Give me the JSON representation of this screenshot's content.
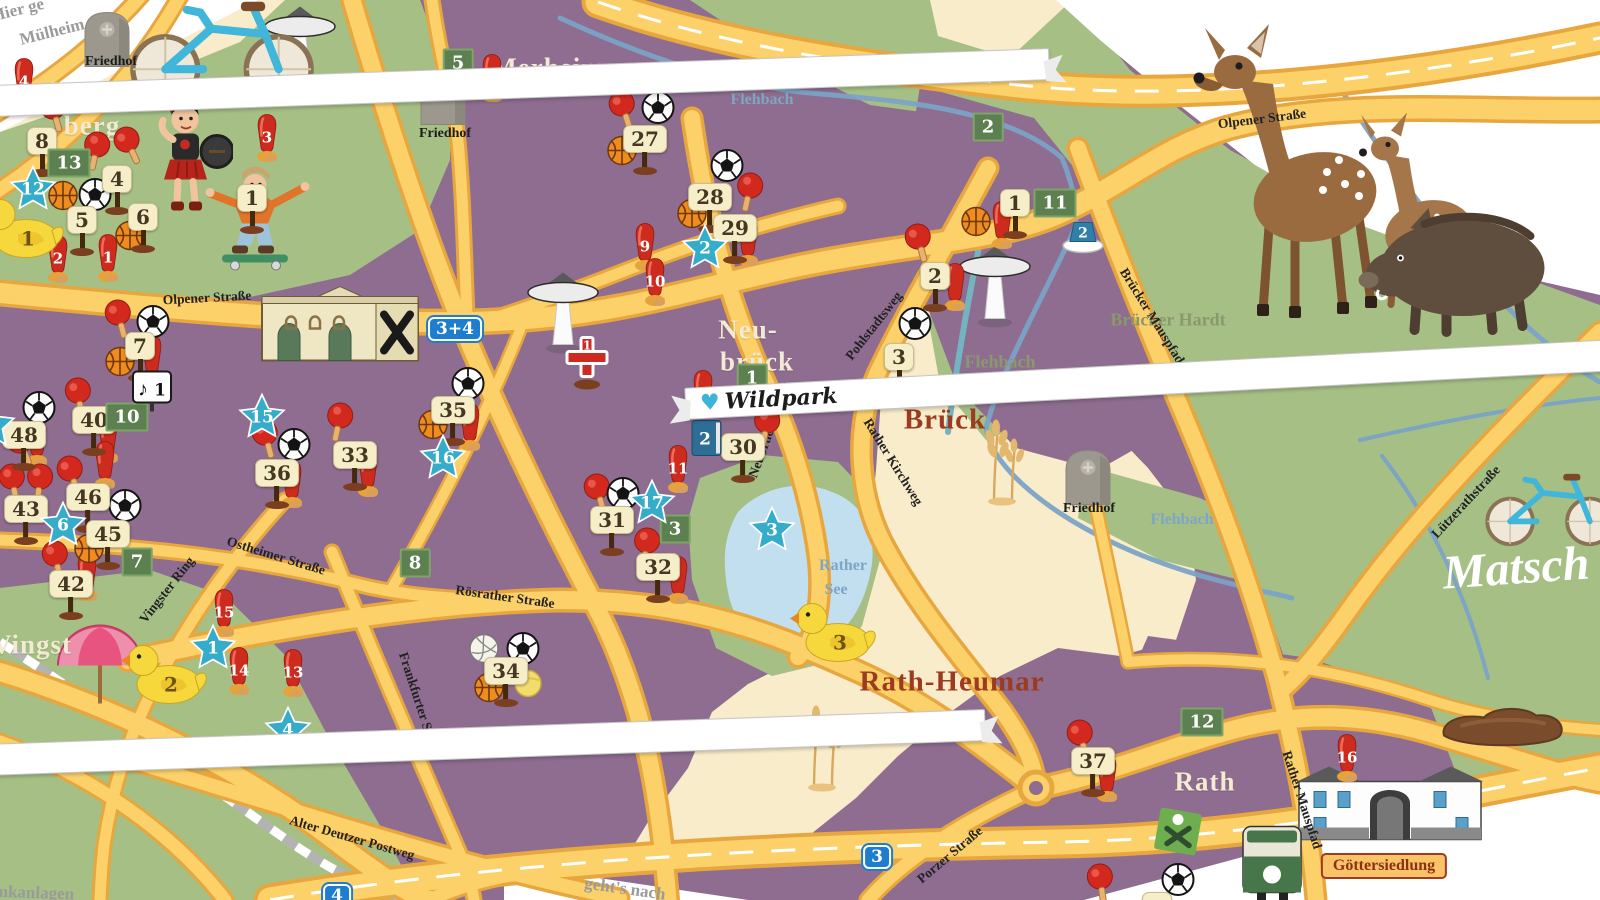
{
  "colors": {
    "purple": "#8e6d90",
    "green": "#a5bf85",
    "cream": "#f9ecca",
    "road_fill": "#fcd169",
    "road_edge": "#e8a73e",
    "lake": "#c2dff0",
    "river": "#7ba3c6",
    "star": "#35adca",
    "cone_red": "#cd2b1d",
    "sign_cream": "#f5eec9",
    "green_sign": "#5d8050",
    "blue_sign": "#1e7ecd"
  },
  "labels": {
    "districts": [
      {
        "text": "Höhen-",
        "x": 96,
        "y": 92
      },
      {
        "text": "berg",
        "x": 92,
        "y": 126
      },
      {
        "text": "Merheim",
        "x": 548,
        "y": 68
      },
      {
        "text": "Neu-",
        "x": 748,
        "y": 330
      },
      {
        "text": "brück",
        "x": 757,
        "y": 362
      },
      {
        "text": "Vingst",
        "x": 32,
        "y": 645
      },
      {
        "text": "Ostheim",
        "x": 350,
        "y": 742
      },
      {
        "text": "Rath",
        "x": 1205,
        "y": 782
      }
    ],
    "districts_red": [
      {
        "text": "Brück",
        "x": 945,
        "y": 420
      },
      {
        "text": "Rath-Heumar",
        "x": 952,
        "y": 682
      }
    ],
    "nature": [
      {
        "text": "Brücker Hardt",
        "x": 1168,
        "y": 320
      },
      {
        "text": "Flehbach",
        "x": 1000,
        "y": 362
      },
      {
        "text": "Aue",
        "x": 984,
        "y": 384
      }
    ],
    "waters": [
      {
        "text": "Flehbach",
        "x": 762,
        "y": 100
      },
      {
        "text": "Flehbach",
        "x": 1182,
        "y": 520
      },
      {
        "text": "Flehbach",
        "x": 1434,
        "y": 366
      },
      {
        "text": "Rather",
        "x": 843,
        "y": 566
      },
      {
        "text": "See",
        "x": 836,
        "y": 590
      }
    ],
    "streets": [
      {
        "text": "Olpener Straße",
        "x": 207,
        "y": 298,
        "rot": -3
      },
      {
        "text": "Olpener Straße",
        "x": 1262,
        "y": 119,
        "rot": -7
      },
      {
        "text": "Ostheimer Straße",
        "x": 276,
        "y": 556,
        "rot": 17
      },
      {
        "text": "Vingster Ring",
        "x": 167,
        "y": 590,
        "rot": -52
      },
      {
        "text": "Frankfurter Straße",
        "x": 420,
        "y": 706,
        "rot": 72
      },
      {
        "text": "Rösrather Straße",
        "x": 505,
        "y": 597,
        "rot": 8
      },
      {
        "text": "Alter Deutzer Postweg",
        "x": 352,
        "y": 838,
        "rot": 16
      },
      {
        "text": "Porzer Straße",
        "x": 950,
        "y": 855,
        "rot": -40
      },
      {
        "text": "Pohlstadtsweg",
        "x": 874,
        "y": 326,
        "rot": -52
      },
      {
        "text": "Rather Kirchweg",
        "x": 893,
        "y": 462,
        "rot": 58
      },
      {
        "text": "Neubrücker Ring",
        "x": 770,
        "y": 430,
        "rot": -70
      },
      {
        "text": "Brücker Mauspfad",
        "x": 1152,
        "y": 316,
        "rot": 58
      },
      {
        "text": "Rather Mauspfad",
        "x": 1302,
        "y": 800,
        "rot": 72
      },
      {
        "text": "Lützerathstraße",
        "x": 1466,
        "y": 502,
        "rot": -47
      }
    ],
    "pois": [
      {
        "text": "Friedhof",
        "x": 111,
        "y": 62
      },
      {
        "text": "Friedhof",
        "x": 445,
        "y": 134
      },
      {
        "text": "Friedhof",
        "x": 1089,
        "y": 509
      }
    ],
    "corners": [
      {
        "text": "Hier ge",
        "x": 18,
        "y": 10,
        "rot": -14
      },
      {
        "text": "Mülheim",
        "x": 52,
        "y": 32,
        "rot": -14
      },
      {
        "text": "mkanlagen",
        "x": 34,
        "y": 893,
        "rot": 2
      },
      {
        "text": "geht's nach",
        "x": 625,
        "y": 889,
        "rot": 8
      }
    ],
    "script": {
      "text": "Matsch",
      "x": 1516,
      "y": 568,
      "rot": -4
    },
    "plaque": {
      "text": "Göttersiedlung",
      "x": 1384,
      "y": 866
    }
  },
  "banners": [
    {
      "text": "Merheimer Heide",
      "x": 250,
      "y": 92,
      "rot": -2
    },
    {
      "text": "Naturfreibad",
      "x": 186,
      "y": 721,
      "rot": -2
    },
    {
      "text": "Wildpark",
      "x": 1484,
      "y": 298,
      "rot": -3
    }
  ],
  "markers": {
    "signs": [
      {
        "n": "8",
        "x": 42,
        "y": 138
      },
      {
        "n": "4",
        "x": 117,
        "y": 176
      },
      {
        "n": "5",
        "x": 82,
        "y": 217
      },
      {
        "n": "6",
        "x": 143,
        "y": 214
      },
      {
        "n": "1",
        "x": 252,
        "y": 195
      },
      {
        "n": "7",
        "x": 140,
        "y": 343
      },
      {
        "n": "40",
        "x": 94,
        "y": 417
      },
      {
        "n": "48",
        "x": 24,
        "y": 432
      },
      {
        "n": "36",
        "x": 277,
        "y": 470
      },
      {
        "n": "33",
        "x": 355,
        "y": 452
      },
      {
        "n": "43",
        "x": 26,
        "y": 506
      },
      {
        "n": "46",
        "x": 88,
        "y": 494
      },
      {
        "n": "45",
        "x": 108,
        "y": 531
      },
      {
        "n": "42",
        "x": 71,
        "y": 581
      },
      {
        "n": "35",
        "x": 453,
        "y": 407
      },
      {
        "n": "31",
        "x": 612,
        "y": 517
      },
      {
        "n": "32",
        "x": 658,
        "y": 564
      },
      {
        "n": "30",
        "x": 743,
        "y": 444
      },
      {
        "n": "27",
        "x": 645,
        "y": 136
      },
      {
        "n": "28",
        "x": 710,
        "y": 194
      },
      {
        "n": "29",
        "x": 735,
        "y": 225
      },
      {
        "n": "1",
        "x": 1015,
        "y": 200
      },
      {
        "n": "2",
        "x": 935,
        "y": 273
      },
      {
        "n": "3",
        "x": 899,
        "y": 354
      },
      {
        "n": "34",
        "x": 506,
        "y": 668
      },
      {
        "n": "37",
        "x": 1093,
        "y": 758
      },
      {
        "n": "",
        "x": 1157,
        "y": 903
      }
    ],
    "green_signs": [
      {
        "n": "13",
        "x": 69,
        "y": 163
      },
      {
        "n": "5",
        "x": 458,
        "y": 63
      },
      {
        "n": "2",
        "x": 988,
        "y": 127
      },
      {
        "n": "11",
        "x": 1055,
        "y": 203
      },
      {
        "n": "1",
        "x": 752,
        "y": 378
      },
      {
        "n": "10",
        "x": 127,
        "y": 417
      },
      {
        "n": "7",
        "x": 137,
        "y": 562
      },
      {
        "n": "8",
        "x": 415,
        "y": 563
      },
      {
        "n": "3",
        "x": 675,
        "y": 529
      },
      {
        "n": "12",
        "x": 1202,
        "y": 722
      }
    ],
    "blue_signs": [
      {
        "n": "4",
        "x": 887,
        "y": 68
      },
      {
        "n": "3+4",
        "x": 455,
        "y": 329
      },
      {
        "n": "3",
        "x": 877,
        "y": 857
      },
      {
        "n": "4",
        "x": 337,
        "y": 896
      }
    ],
    "stars": [
      {
        "n": "12",
        "x": 33,
        "y": 192
      },
      {
        "n": "2",
        "x": 705,
        "y": 251
      },
      {
        "n": "15",
        "x": 262,
        "y": 420
      },
      {
        "n": "16",
        "x": 443,
        "y": 461
      },
      {
        "n": "6",
        "x": 63,
        "y": 528
      },
      {
        "n": "17",
        "x": 652,
        "y": 506
      },
      {
        "n": "3",
        "x": 772,
        "y": 533
      },
      {
        "n": "1",
        "x": 213,
        "y": 651
      },
      {
        "n": "4",
        "x": 288,
        "y": 733
      },
      {
        "n": "4",
        "x": -8,
        "y": 428
      }
    ],
    "cones": [
      {
        "n": "4",
        "x": 24,
        "y": 85
      },
      {
        "n": "8",
        "x": 492,
        "y": 81
      },
      {
        "n": "3",
        "x": 267,
        "y": 141
      },
      {
        "n": "2",
        "x": 58,
        "y": 262
      },
      {
        "n": "1",
        "x": 108,
        "y": 261
      },
      {
        "n": "9",
        "x": 645,
        "y": 250
      },
      {
        "n": "10",
        "x": 655,
        "y": 285
      },
      {
        "n": "12",
        "x": 703,
        "y": 397
      },
      {
        "n": "11",
        "x": 678,
        "y": 472
      },
      {
        "n": "15",
        "x": 224,
        "y": 616
      },
      {
        "n": "14",
        "x": 239,
        "y": 674
      },
      {
        "n": "13",
        "x": 293,
        "y": 676
      },
      {
        "n": "16",
        "x": 1347,
        "y": 761
      }
    ],
    "plain_cones": [
      {
        "x": 152,
        "y": 362
      },
      {
        "x": 108,
        "y": 442
      },
      {
        "x": 292,
        "y": 487
      },
      {
        "x": 368,
        "y": 476
      },
      {
        "x": 470,
        "y": 430
      },
      {
        "x": 955,
        "y": 290
      },
      {
        "x": 748,
        "y": 245
      },
      {
        "x": 678,
        "y": 583
      },
      {
        "x": 1002,
        "y": 228
      },
      {
        "x": 37,
        "y": 445
      },
      {
        "x": 105,
        "y": 468
      },
      {
        "x": 87,
        "y": 580
      },
      {
        "x": 1107,
        "y": 781
      }
    ],
    "paddles": [
      {
        "x": 53,
        "y": 116,
        "r": -15
      },
      {
        "x": 97,
        "y": 154,
        "r": 12
      },
      {
        "x": 127,
        "y": 149,
        "r": -25
      },
      {
        "x": 118,
        "y": 322,
        "r": -15
      },
      {
        "x": 78,
        "y": 400,
        "r": -8
      },
      {
        "x": 265,
        "y": 442,
        "r": -15
      },
      {
        "x": 340,
        "y": 425,
        "r": 12
      },
      {
        "x": 12,
        "y": 486,
        "r": -10
      },
      {
        "x": 40,
        "y": 486,
        "r": 6
      },
      {
        "x": 70,
        "y": 478,
        "r": -18
      },
      {
        "x": 20,
        "y": 450,
        "r": -22
      },
      {
        "x": 55,
        "y": 563,
        "r": -12
      },
      {
        "x": 597,
        "y": 496,
        "r": -15
      },
      {
        "x": 647,
        "y": 550,
        "r": 8
      },
      {
        "x": 767,
        "y": 430,
        "r": 10
      },
      {
        "x": 750,
        "y": 195,
        "r": 12
      },
      {
        "x": 622,
        "y": 113,
        "r": -18
      },
      {
        "x": 918,
        "y": 246,
        "r": -15
      },
      {
        "x": 1080,
        "y": 742,
        "r": -15
      },
      {
        "x": 1100,
        "y": 886,
        "r": -8
      }
    ],
    "soccer": [
      {
        "x": 95,
        "y": 197
      },
      {
        "x": 39,
        "y": 410
      },
      {
        "x": 153,
        "y": 324
      },
      {
        "x": 125,
        "y": 508
      },
      {
        "x": 294,
        "y": 447
      },
      {
        "x": 658,
        "y": 110
      },
      {
        "x": 727,
        "y": 168
      },
      {
        "x": 623,
        "y": 496
      },
      {
        "x": 915,
        "y": 326
      },
      {
        "x": 468,
        "y": 386
      },
      {
        "x": 523,
        "y": 651
      },
      {
        "x": 1178,
        "y": 882
      }
    ],
    "basketball": [
      {
        "x": 63,
        "y": 198
      },
      {
        "x": 130,
        "y": 238
      },
      {
        "x": 120,
        "y": 364
      },
      {
        "x": 433,
        "y": 427
      },
      {
        "x": 976,
        "y": 224
      },
      {
        "x": 89,
        "y": 551
      },
      {
        "x": 489,
        "y": 690
      },
      {
        "x": 622,
        "y": 153
      },
      {
        "x": 692,
        "y": 216
      }
    ],
    "volleyball": [
      {
        "x": 484,
        "y": 651
      }
    ],
    "yellow_ball": [
      {
        "x": 528,
        "y": 686
      }
    ],
    "ducks": [
      {
        "n": "1",
        "x": 20,
        "y": 230
      },
      {
        "n": "2",
        "x": 163,
        "y": 676
      },
      {
        "n": "3",
        "x": 832,
        "y": 634
      }
    ],
    "caps": [
      {
        "n": "2",
        "x": 1083,
        "y": 239
      }
    ],
    "books": [
      {
        "n": "2",
        "x": 707,
        "y": 441
      }
    ],
    "music": [
      {
        "n": "1",
        "x": 152,
        "y": 394
      }
    ],
    "cross": [
      {
        "n": "1",
        "x": 587,
        "y": 364
      }
    ],
    "towers": [
      {
        "x": 300,
        "y": 50
      },
      {
        "x": 563,
        "y": 316
      },
      {
        "x": 995,
        "y": 290
      }
    ],
    "umbrellas": [
      {
        "x": 100,
        "y": 666
      }
    ],
    "tombstones": [
      {
        "x": 107,
        "y": 40
      },
      {
        "x": 443,
        "y": 98
      },
      {
        "x": 1088,
        "y": 478
      }
    ],
    "wheat": [
      {
        "x": 1000,
        "y": 462
      },
      {
        "x": 820,
        "y": 748
      }
    ],
    "mud": [
      {
        "x": 1502,
        "y": 728
      }
    ],
    "trams": [
      {
        "x": 1272,
        "y": 866
      }
    ],
    "playgrounds": [
      {
        "x": 1178,
        "y": 834
      }
    ],
    "bikes": [
      {
        "x": 222,
        "y": 42,
        "s": 1.35
      },
      {
        "x": 1550,
        "y": 503,
        "s": 0.95
      }
    ],
    "deer": [
      {
        "x": 1292,
        "y": 172
      }
    ],
    "fawn": [
      {
        "x": 1420,
        "y": 212
      }
    ],
    "boar": [
      {
        "x": 1452,
        "y": 272
      }
    ],
    "roman": [
      {
        "x": 185,
        "y": 158
      }
    ],
    "skater": [
      {
        "x": 258,
        "y": 218
      }
    ],
    "chapel": [
      {
        "x": 340,
        "y": 328
      }
    ],
    "gate": [
      {
        "x": 1390,
        "y": 812
      }
    ]
  }
}
